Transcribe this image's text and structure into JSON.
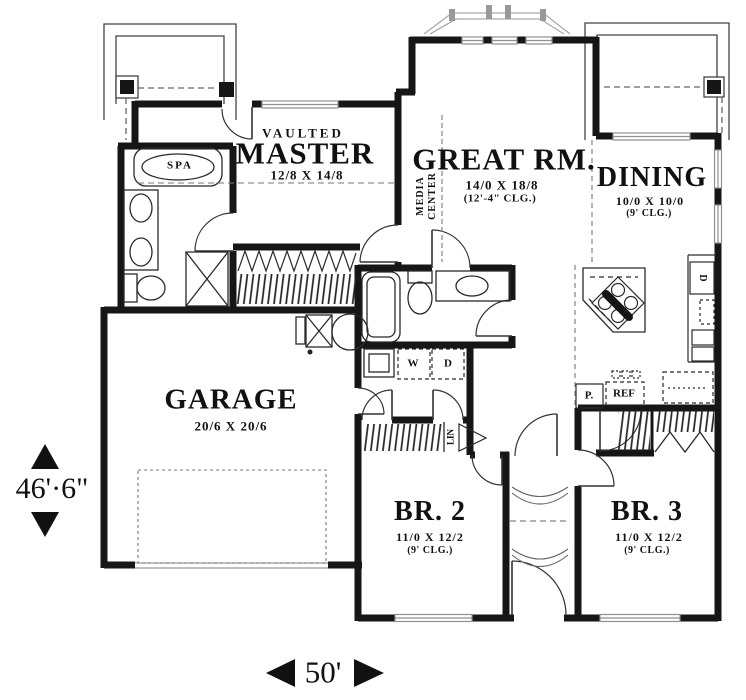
{
  "rooms": {
    "master": {
      "prefix": "VAULTED",
      "name": "MASTER",
      "dims": "12/8 X 14/8"
    },
    "great_room": {
      "name": "GREAT RM.",
      "dims": "14/0 X 18/8",
      "ceiling": "(12'-4\" CLG.)"
    },
    "dining": {
      "name": "DINING",
      "dims": "10/0 X 10/0",
      "ceiling": "(9' CLG.)"
    },
    "garage": {
      "name": "GARAGE",
      "dims": "20/6 X 20/6"
    },
    "bedroom2": {
      "name": "BR. 2",
      "dims": "11/0 X 12/2",
      "ceiling": "(9' CLG.)"
    },
    "bedroom3": {
      "name": "BR. 3",
      "dims": "11/0 X 12/2",
      "ceiling": "(9' CLG.)"
    }
  },
  "labels": {
    "spa": "SPA",
    "media_line1": "MEDIA",
    "media_line2": "CENTER",
    "washer": "W",
    "dryer": "D",
    "linen": "LIN",
    "pantry": "P.",
    "refrigerator": "REF",
    "dishwasher": "D"
  },
  "dimensions": {
    "overall_depth": "46'·6\"",
    "overall_width": "50'"
  },
  "colors": {
    "wall": "#161616",
    "thin_line": "#2a2a2a",
    "dashed_line": "#666666",
    "window": "#909090",
    "text": "#111111",
    "background": "#ffffff"
  }
}
